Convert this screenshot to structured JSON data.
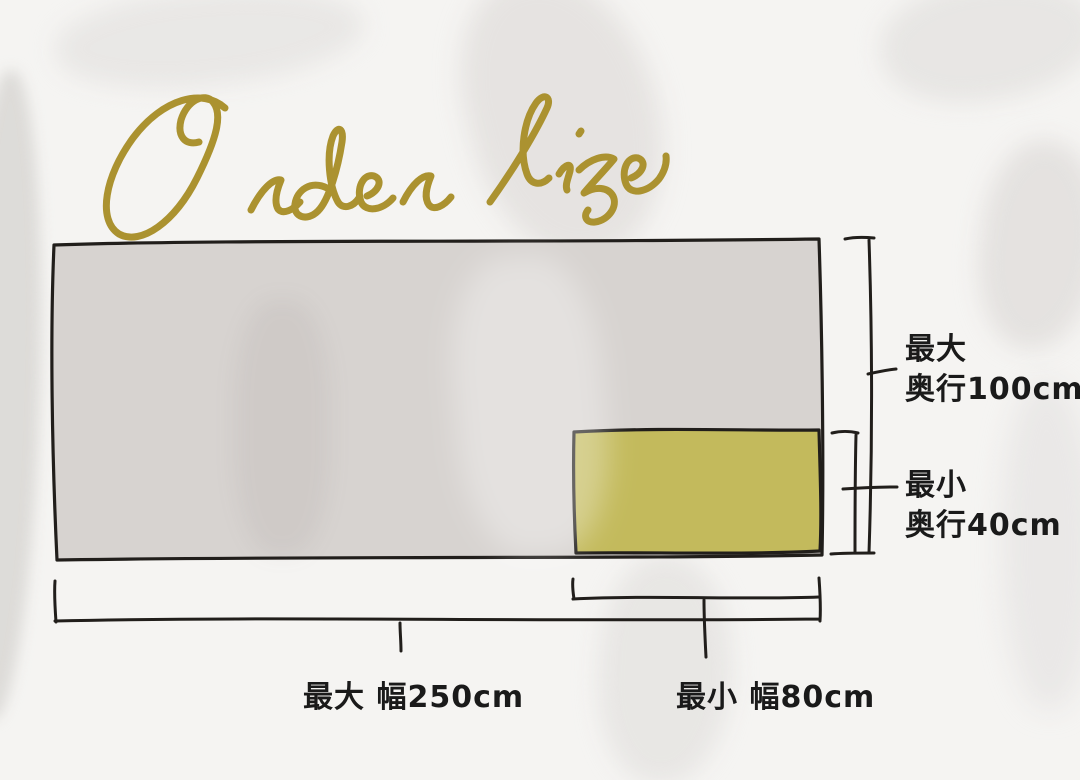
{
  "title": {
    "text": "Order size"
  },
  "labels": {
    "depth_max": {
      "line1": "最大",
      "line2": "奥行100cm"
    },
    "depth_min": {
      "line1": "最小",
      "line2": "奥行40cm"
    },
    "width_max": "最大 幅250cm",
    "width_min": "最小 幅80cm"
  },
  "dimensions": {
    "max": {
      "width_cm": 250,
      "depth_cm": 100
    },
    "min": {
      "width_cm": 80,
      "depth_cm": 40
    }
  },
  "colors": {
    "accent_gold": "#AB9230",
    "line": "#211E1B",
    "max_rect_fill": "#D7D3D0",
    "min_rect_fill": "#C3BA5C",
    "label_text": "#1A1A1A",
    "background": "#F5F4F2"
  }
}
